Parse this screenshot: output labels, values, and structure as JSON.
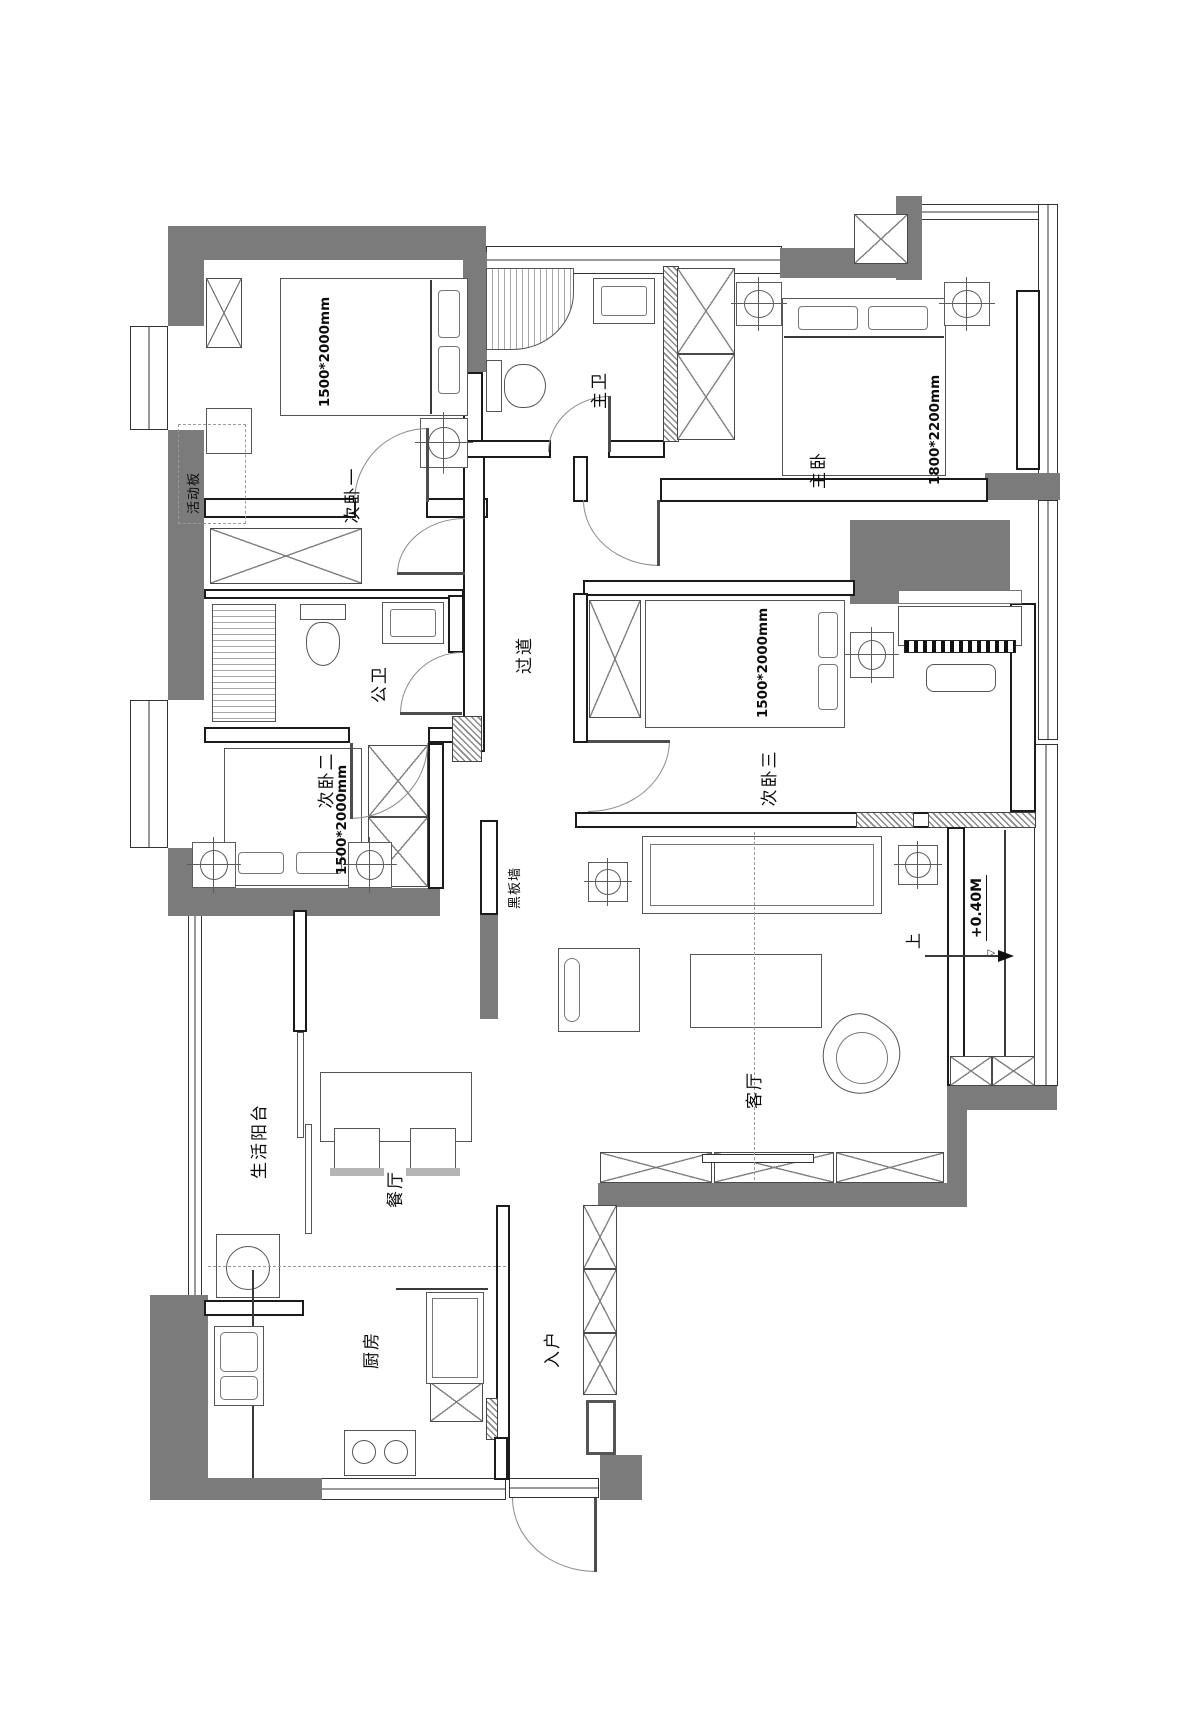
{
  "plan": {
    "colors": {
      "wall": "#7b7b7b",
      "line": "#1b1b1b"
    },
    "rooms": {
      "bedroom1": {
        "label": "次卧一",
        "bed_dim": "1500*2000mm"
      },
      "master_bath": {
        "label": "主卫"
      },
      "master_bedroom": {
        "label": "主卧",
        "bed_dim": "1800*2200mm"
      },
      "corridor": {
        "label": "过道"
      },
      "public_bath": {
        "label": "公卫"
      },
      "bedroom2": {
        "label": "次卧二",
        "bed_dim": "1500*2000mm"
      },
      "bedroom3": {
        "label": "次卧三",
        "bed_dim": "1500*2000mm"
      },
      "living": {
        "label": "客厅"
      },
      "dining": {
        "label": "餐厅"
      },
      "balcony": {
        "label": "生活阳台"
      },
      "kitchen": {
        "label": "厨房"
      },
      "entry": {
        "label": "入户"
      }
    },
    "annotations": {
      "blackboard_wall": "黑板墙",
      "movable_panel": "活动板",
      "floor_level": "+0.40M",
      "up": "上"
    }
  }
}
